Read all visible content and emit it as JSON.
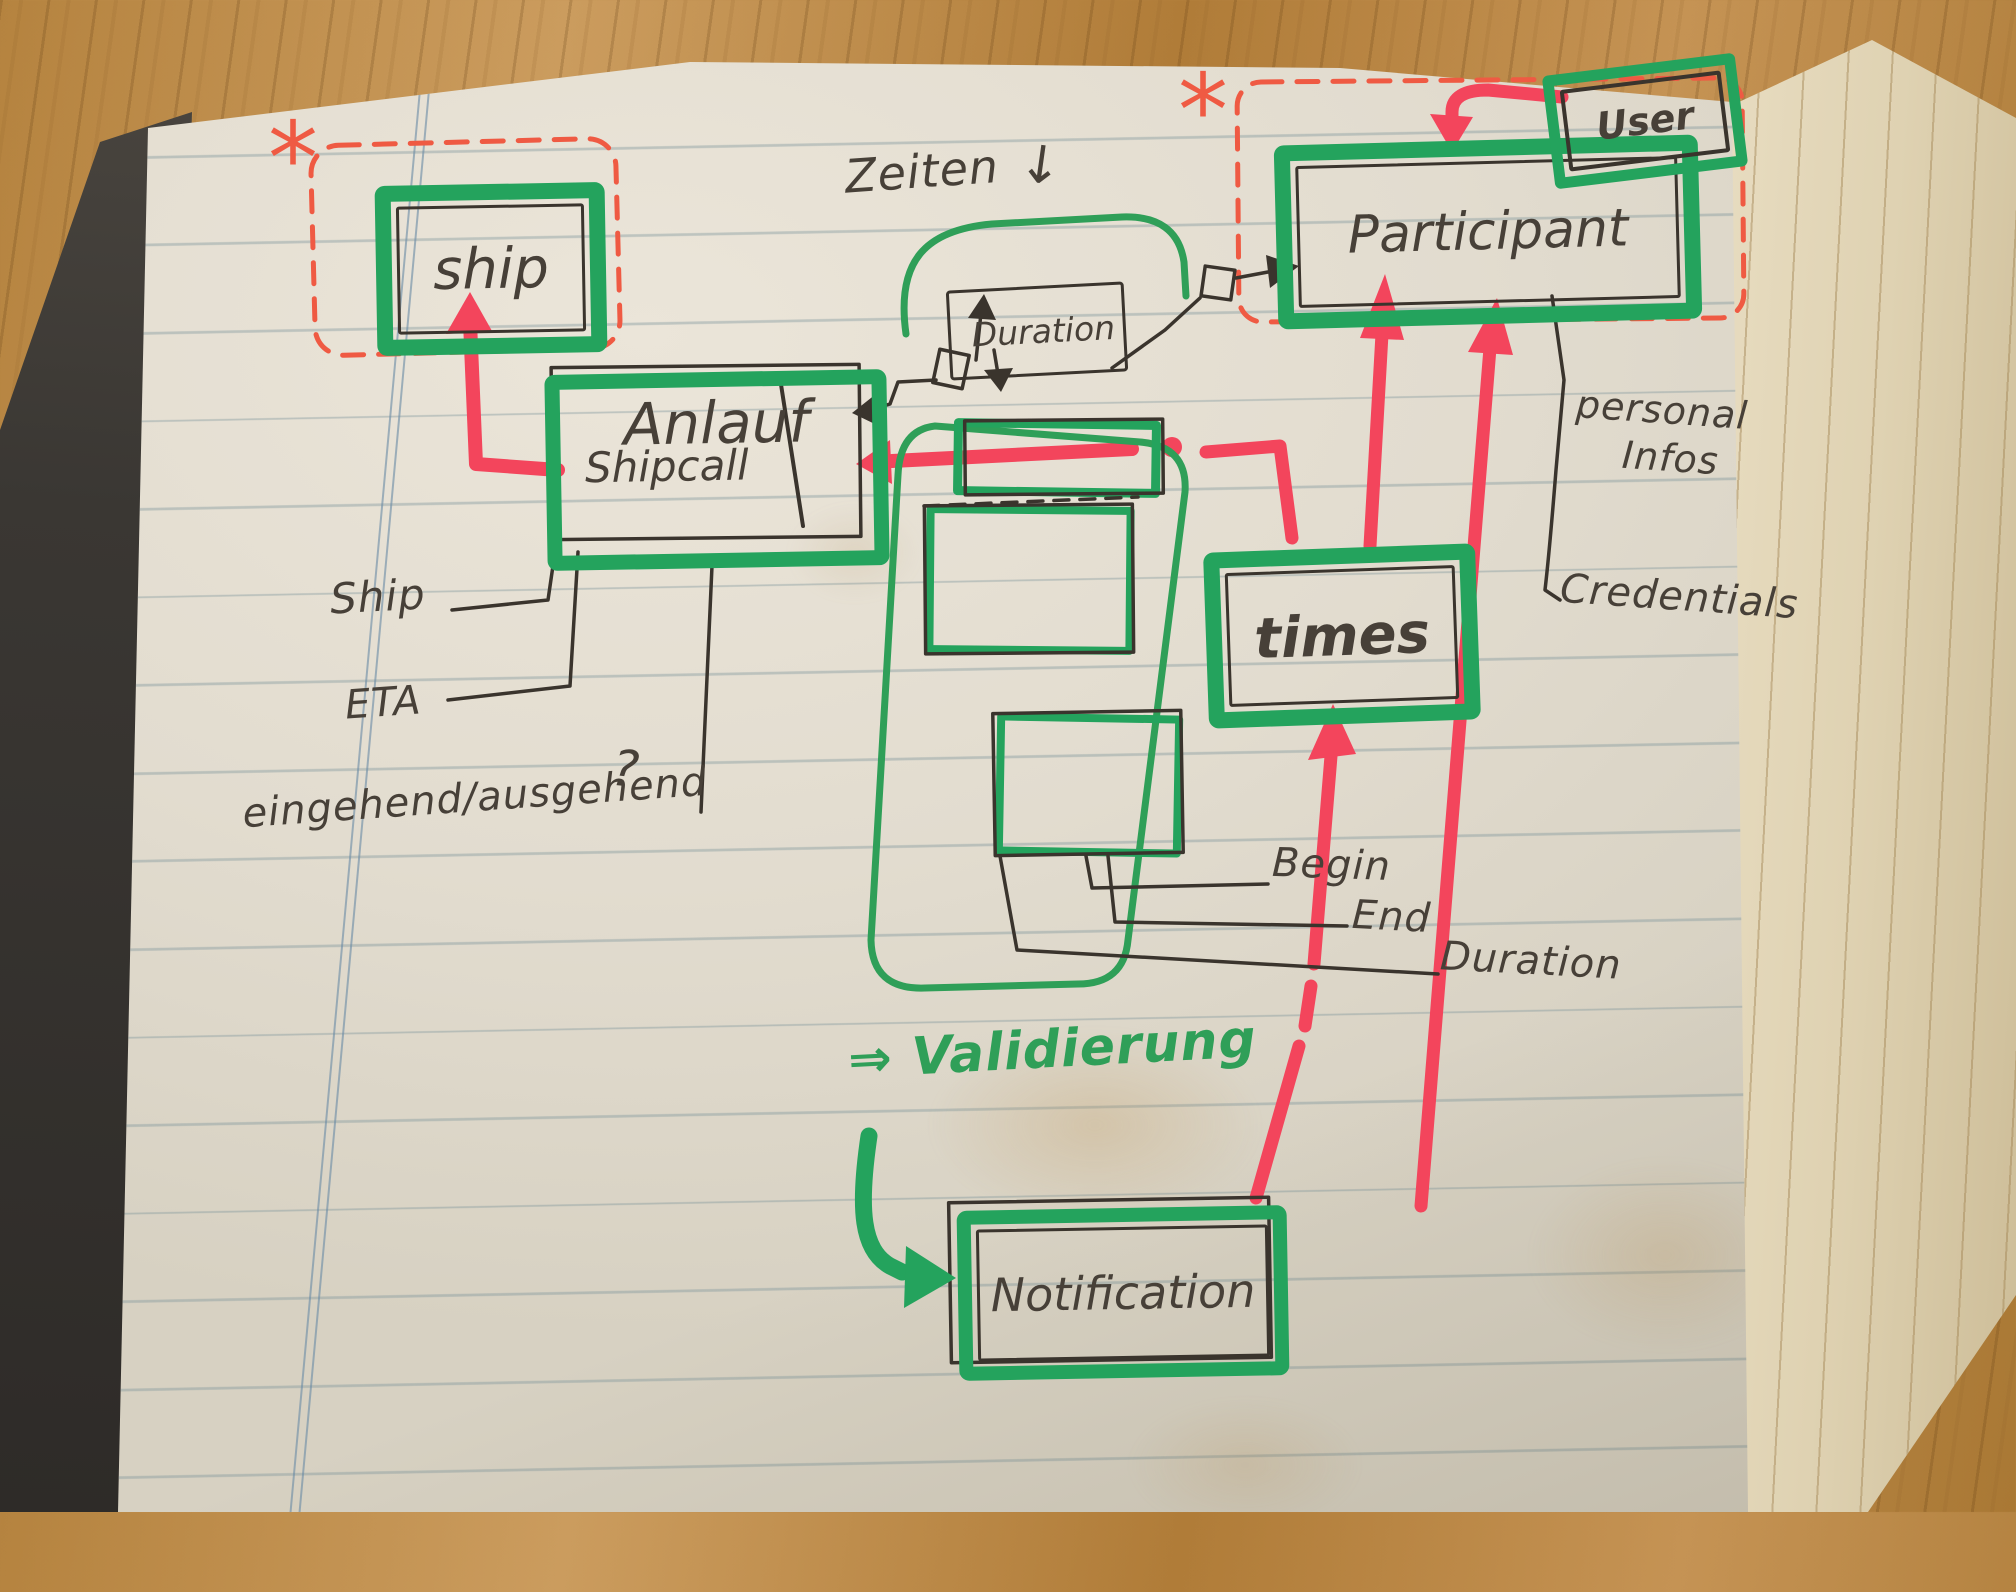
{
  "colors": {
    "marker_green": "#24a35d",
    "pen_green": "#2f9f58",
    "marker_red": "#f3455c",
    "pen_red": "#ef5a43",
    "pen_black": "#3a342d"
  },
  "entities": {
    "ship": {
      "label": "ship"
    },
    "shipcall": {
      "label_old": "Anlauf",
      "label_new": "Shipcall"
    },
    "participant": {
      "label": "Participant"
    },
    "user": {
      "label": "User"
    },
    "duration": {
      "label": "Duration"
    },
    "times": {
      "label": "times"
    },
    "notification": {
      "label": "Notification"
    }
  },
  "annotations": {
    "zeiten": "Zeiten",
    "zeiten_arrow": "↓",
    "asterisk": "*",
    "ship_attr": "Ship",
    "eta_attr": "ETA",
    "inout_attr": "eingehend/ausgehend",
    "question_mark": "?",
    "begin_attr": "Begin",
    "end_attr": "End",
    "duration_attr": "Duration",
    "personal_line1": "personal",
    "personal_line2": "Infos",
    "credentials_attr": "Credentials",
    "validierung": "⇒ Validierung"
  }
}
